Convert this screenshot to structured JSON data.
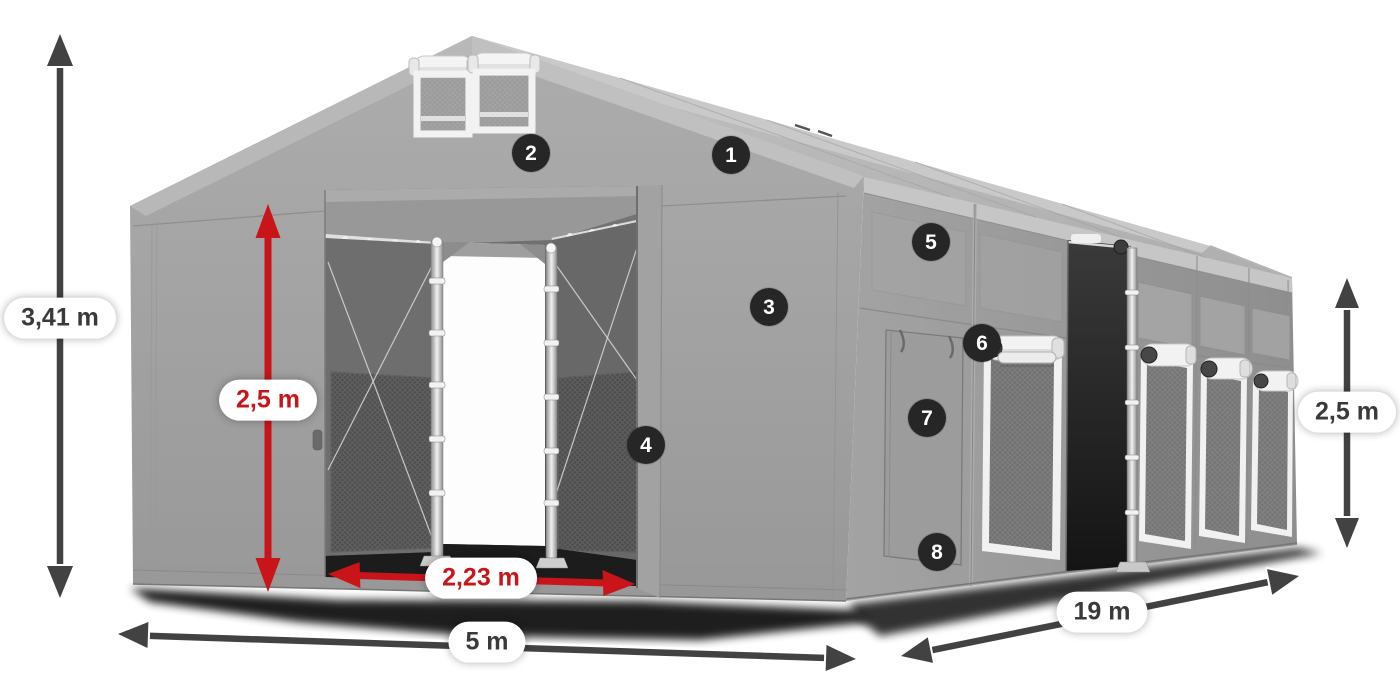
{
  "dimensions": {
    "total_height": {
      "value": "3,41 m",
      "style": "dark"
    },
    "door_height": {
      "value": "2,5 m",
      "style": "red"
    },
    "door_width": {
      "value": "2,23 m",
      "style": "red"
    },
    "width": {
      "value": "5 m",
      "style": "dark"
    },
    "length": {
      "value": "19 m",
      "style": "dark"
    },
    "side_height": {
      "value": "2,5 m",
      "style": "dark"
    }
  },
  "markers": [
    {
      "label": "1"
    },
    {
      "label": "2"
    },
    {
      "label": "3"
    },
    {
      "label": "4"
    },
    {
      "label": "5"
    },
    {
      "label": "6"
    },
    {
      "label": "7"
    },
    {
      "label": "8"
    }
  ],
  "colors": {
    "dimension_red": "#c9151a",
    "dimension_dark": "#424242",
    "marker_bg": "#262626",
    "marker_text": "#ffffff",
    "label_bg": "#ffffff",
    "label_text": "#3a3a3a"
  }
}
